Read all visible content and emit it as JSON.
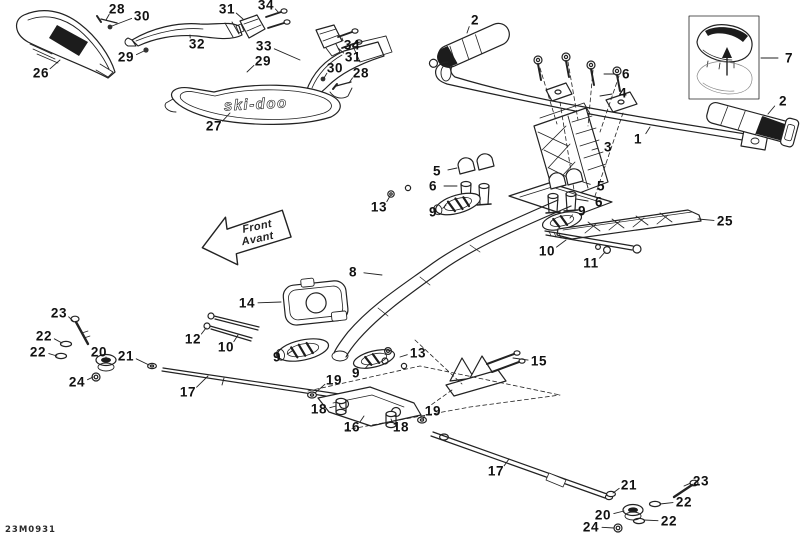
{
  "diagram": {
    "part_code": "23M0931",
    "brand_text": "ski-doo",
    "direction_arrow": {
      "line1": "Front",
      "line2": "Avant"
    },
    "colors": {
      "line": "#222222",
      "fill_dark": "#1c1c1c",
      "background": "#ffffff"
    },
    "callouts": [
      {
        "n": "28",
        "x": 117,
        "y": 9,
        "tx": 106,
        "ty": 20
      },
      {
        "n": "30",
        "x": 142,
        "y": 16,
        "tx": 112,
        "ty": 26
      },
      {
        "n": "31",
        "x": 227,
        "y": 9,
        "tx": 243,
        "ty": 19
      },
      {
        "n": "34",
        "x": 266,
        "y": 5,
        "tx": 279,
        "ty": 13
      },
      {
        "n": "32",
        "x": 197,
        "y": 44,
        "tx": 190,
        "ty": 35
      },
      {
        "n": "29",
        "x": 126,
        "y": 57,
        "tx": 144,
        "ty": 51
      },
      {
        "n": "33",
        "x": 264,
        "y": 46,
        "tx": 300,
        "ty": 60
      },
      {
        "n": "29",
        "x": 263,
        "y": 61,
        "tx": 247,
        "ty": 72
      },
      {
        "n": "34",
        "x": 352,
        "y": 45,
        "tx": 342,
        "ty": 38
      },
      {
        "n": "31",
        "x": 353,
        "y": 57,
        "tx": 338,
        "ty": 48
      },
      {
        "n": "30",
        "x": 335,
        "y": 68,
        "tx": 324,
        "ty": 78
      },
      {
        "n": "28",
        "x": 361,
        "y": 73,
        "tx": 349,
        "ty": 83
      },
      {
        "n": "26",
        "x": 41,
        "y": 73,
        "tx": 60,
        "ty": 60
      },
      {
        "n": "27",
        "x": 214,
        "y": 126,
        "tx": 230,
        "ty": 113
      },
      {
        "n": "2",
        "x": 475,
        "y": 20,
        "tx": 467,
        "ty": 33
      },
      {
        "n": "6",
        "x": 626,
        "y": 74,
        "tx": 604,
        "ty": 74
      },
      {
        "n": "4",
        "x": 623,
        "y": 93,
        "tx": 600,
        "ty": 96
      },
      {
        "n": "7",
        "x": 789,
        "y": 58,
        "tx": 761,
        "ty": 58
      },
      {
        "n": "2",
        "x": 783,
        "y": 101,
        "tx": 768,
        "ty": 114
      },
      {
        "n": "1",
        "x": 638,
        "y": 139,
        "tx": 650,
        "ty": 127
      },
      {
        "n": "3",
        "x": 608,
        "y": 147,
        "tx": 592,
        "ty": 150
      },
      {
        "n": "5",
        "x": 437,
        "y": 171,
        "tx": 457,
        "ty": 168
      },
      {
        "n": "6",
        "x": 433,
        "y": 186,
        "tx": 457,
        "ty": 186
      },
      {
        "n": "13",
        "x": 379,
        "y": 207,
        "tx": 390,
        "ty": 196
      },
      {
        "n": "9",
        "x": 433,
        "y": 212,
        "tx": 446,
        "ty": 205
      },
      {
        "n": "5",
        "x": 601,
        "y": 186,
        "tx": 583,
        "ty": 182
      },
      {
        "n": "6",
        "x": 599,
        "y": 202,
        "tx": 576,
        "ty": 199
      },
      {
        "n": "9",
        "x": 582,
        "y": 211,
        "tx": 570,
        "ty": 218
      },
      {
        "n": "10",
        "x": 547,
        "y": 251,
        "tx": 566,
        "ty": 240
      },
      {
        "n": "11",
        "x": 591,
        "y": 263,
        "tx": 605,
        "ty": 252
      },
      {
        "n": "25",
        "x": 725,
        "y": 221,
        "tx": 698,
        "ty": 219
      },
      {
        "n": "8",
        "x": 353,
        "y": 272,
        "tx": 382,
        "ty": 275
      },
      {
        "n": "14",
        "x": 247,
        "y": 303,
        "tx": 281,
        "ty": 302
      },
      {
        "n": "12",
        "x": 193,
        "y": 339,
        "tx": 206,
        "ty": 328
      },
      {
        "n": "10",
        "x": 226,
        "y": 347,
        "tx": 238,
        "ty": 335
      },
      {
        "n": "9",
        "x": 277,
        "y": 357,
        "tx": 292,
        "ty": 351
      },
      {
        "n": "23",
        "x": 59,
        "y": 313,
        "tx": 73,
        "ty": 321
      },
      {
        "n": "22",
        "x": 44,
        "y": 336,
        "tx": 62,
        "ty": 343
      },
      {
        "n": "22",
        "x": 38,
        "y": 352,
        "tx": 57,
        "ty": 356
      },
      {
        "n": "20",
        "x": 99,
        "y": 352,
        "tx": 106,
        "ty": 359
      },
      {
        "n": "21",
        "x": 126,
        "y": 356,
        "tx": 149,
        "ty": 365
      },
      {
        "n": "24",
        "x": 77,
        "y": 382,
        "tx": 93,
        "ty": 377
      },
      {
        "n": "17",
        "x": 188,
        "y": 392,
        "tx": 208,
        "ty": 376
      },
      {
        "n": "13",
        "x": 418,
        "y": 353,
        "tx": 400,
        "ty": 357
      },
      {
        "n": "9",
        "x": 356,
        "y": 373,
        "tx": 370,
        "ty": 363
      },
      {
        "n": "19",
        "x": 334,
        "y": 380,
        "tx": 315,
        "ty": 393
      },
      {
        "n": "18",
        "x": 319,
        "y": 409,
        "tx": 336,
        "ty": 406
      },
      {
        "n": "16",
        "x": 352,
        "y": 427,
        "tx": 364,
        "ty": 416
      },
      {
        "n": "18",
        "x": 401,
        "y": 427,
        "tx": 391,
        "ty": 419
      },
      {
        "n": "19",
        "x": 433,
        "y": 411,
        "tx": 423,
        "ty": 419
      },
      {
        "n": "15",
        "x": 539,
        "y": 361,
        "tx": 513,
        "ty": 358
      },
      {
        "n": "17",
        "x": 496,
        "y": 471,
        "tx": 509,
        "ty": 459
      },
      {
        "n": "21",
        "x": 629,
        "y": 485,
        "tx": 613,
        "ty": 493
      },
      {
        "n": "23",
        "x": 701,
        "y": 481,
        "tx": 684,
        "ty": 486
      },
      {
        "n": "22",
        "x": 684,
        "y": 502,
        "tx": 660,
        "ty": 504
      },
      {
        "n": "20",
        "x": 603,
        "y": 515,
        "tx": 624,
        "ty": 511
      },
      {
        "n": "22",
        "x": 669,
        "y": 521,
        "tx": 644,
        "ty": 520
      },
      {
        "n": "24",
        "x": 591,
        "y": 527,
        "tx": 614,
        "ty": 528
      }
    ]
  }
}
